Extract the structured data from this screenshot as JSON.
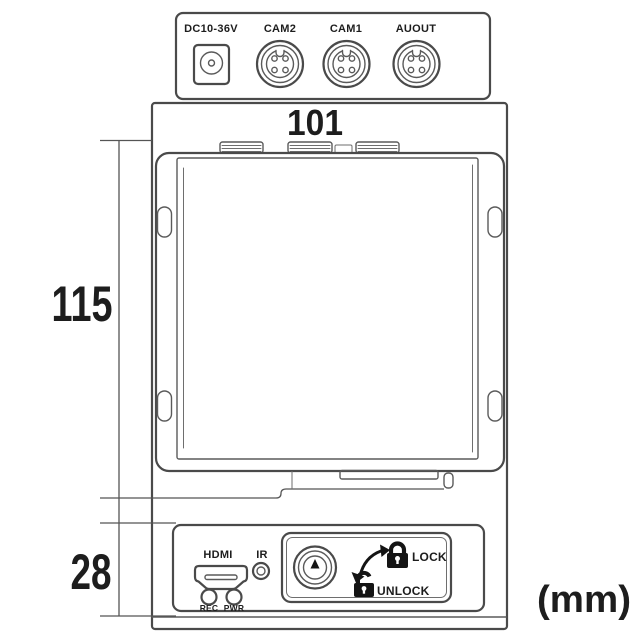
{
  "colors": {
    "background": "#ffffff",
    "line": "#4a4a4a",
    "line_soft": "#6e6e6e",
    "text": "#1d1d1d",
    "icon_fill": "#141414"
  },
  "top_view": {
    "dc_input_label": "DC10-36V",
    "cam2_label": "CAM2",
    "cam1_label": "CAM1",
    "audio_out_label": "AUOUT"
  },
  "dimensions": {
    "width": "101",
    "height": "115",
    "front_height": "28",
    "unit": "(mm)"
  },
  "front_panel": {
    "hdmi_label": "HDMI",
    "ir_label": "IR",
    "rec_led_label": "REC",
    "pwr_led_label": "PWR",
    "lock_label": "LOCK",
    "unlock_label": "UNLOCK"
  }
}
